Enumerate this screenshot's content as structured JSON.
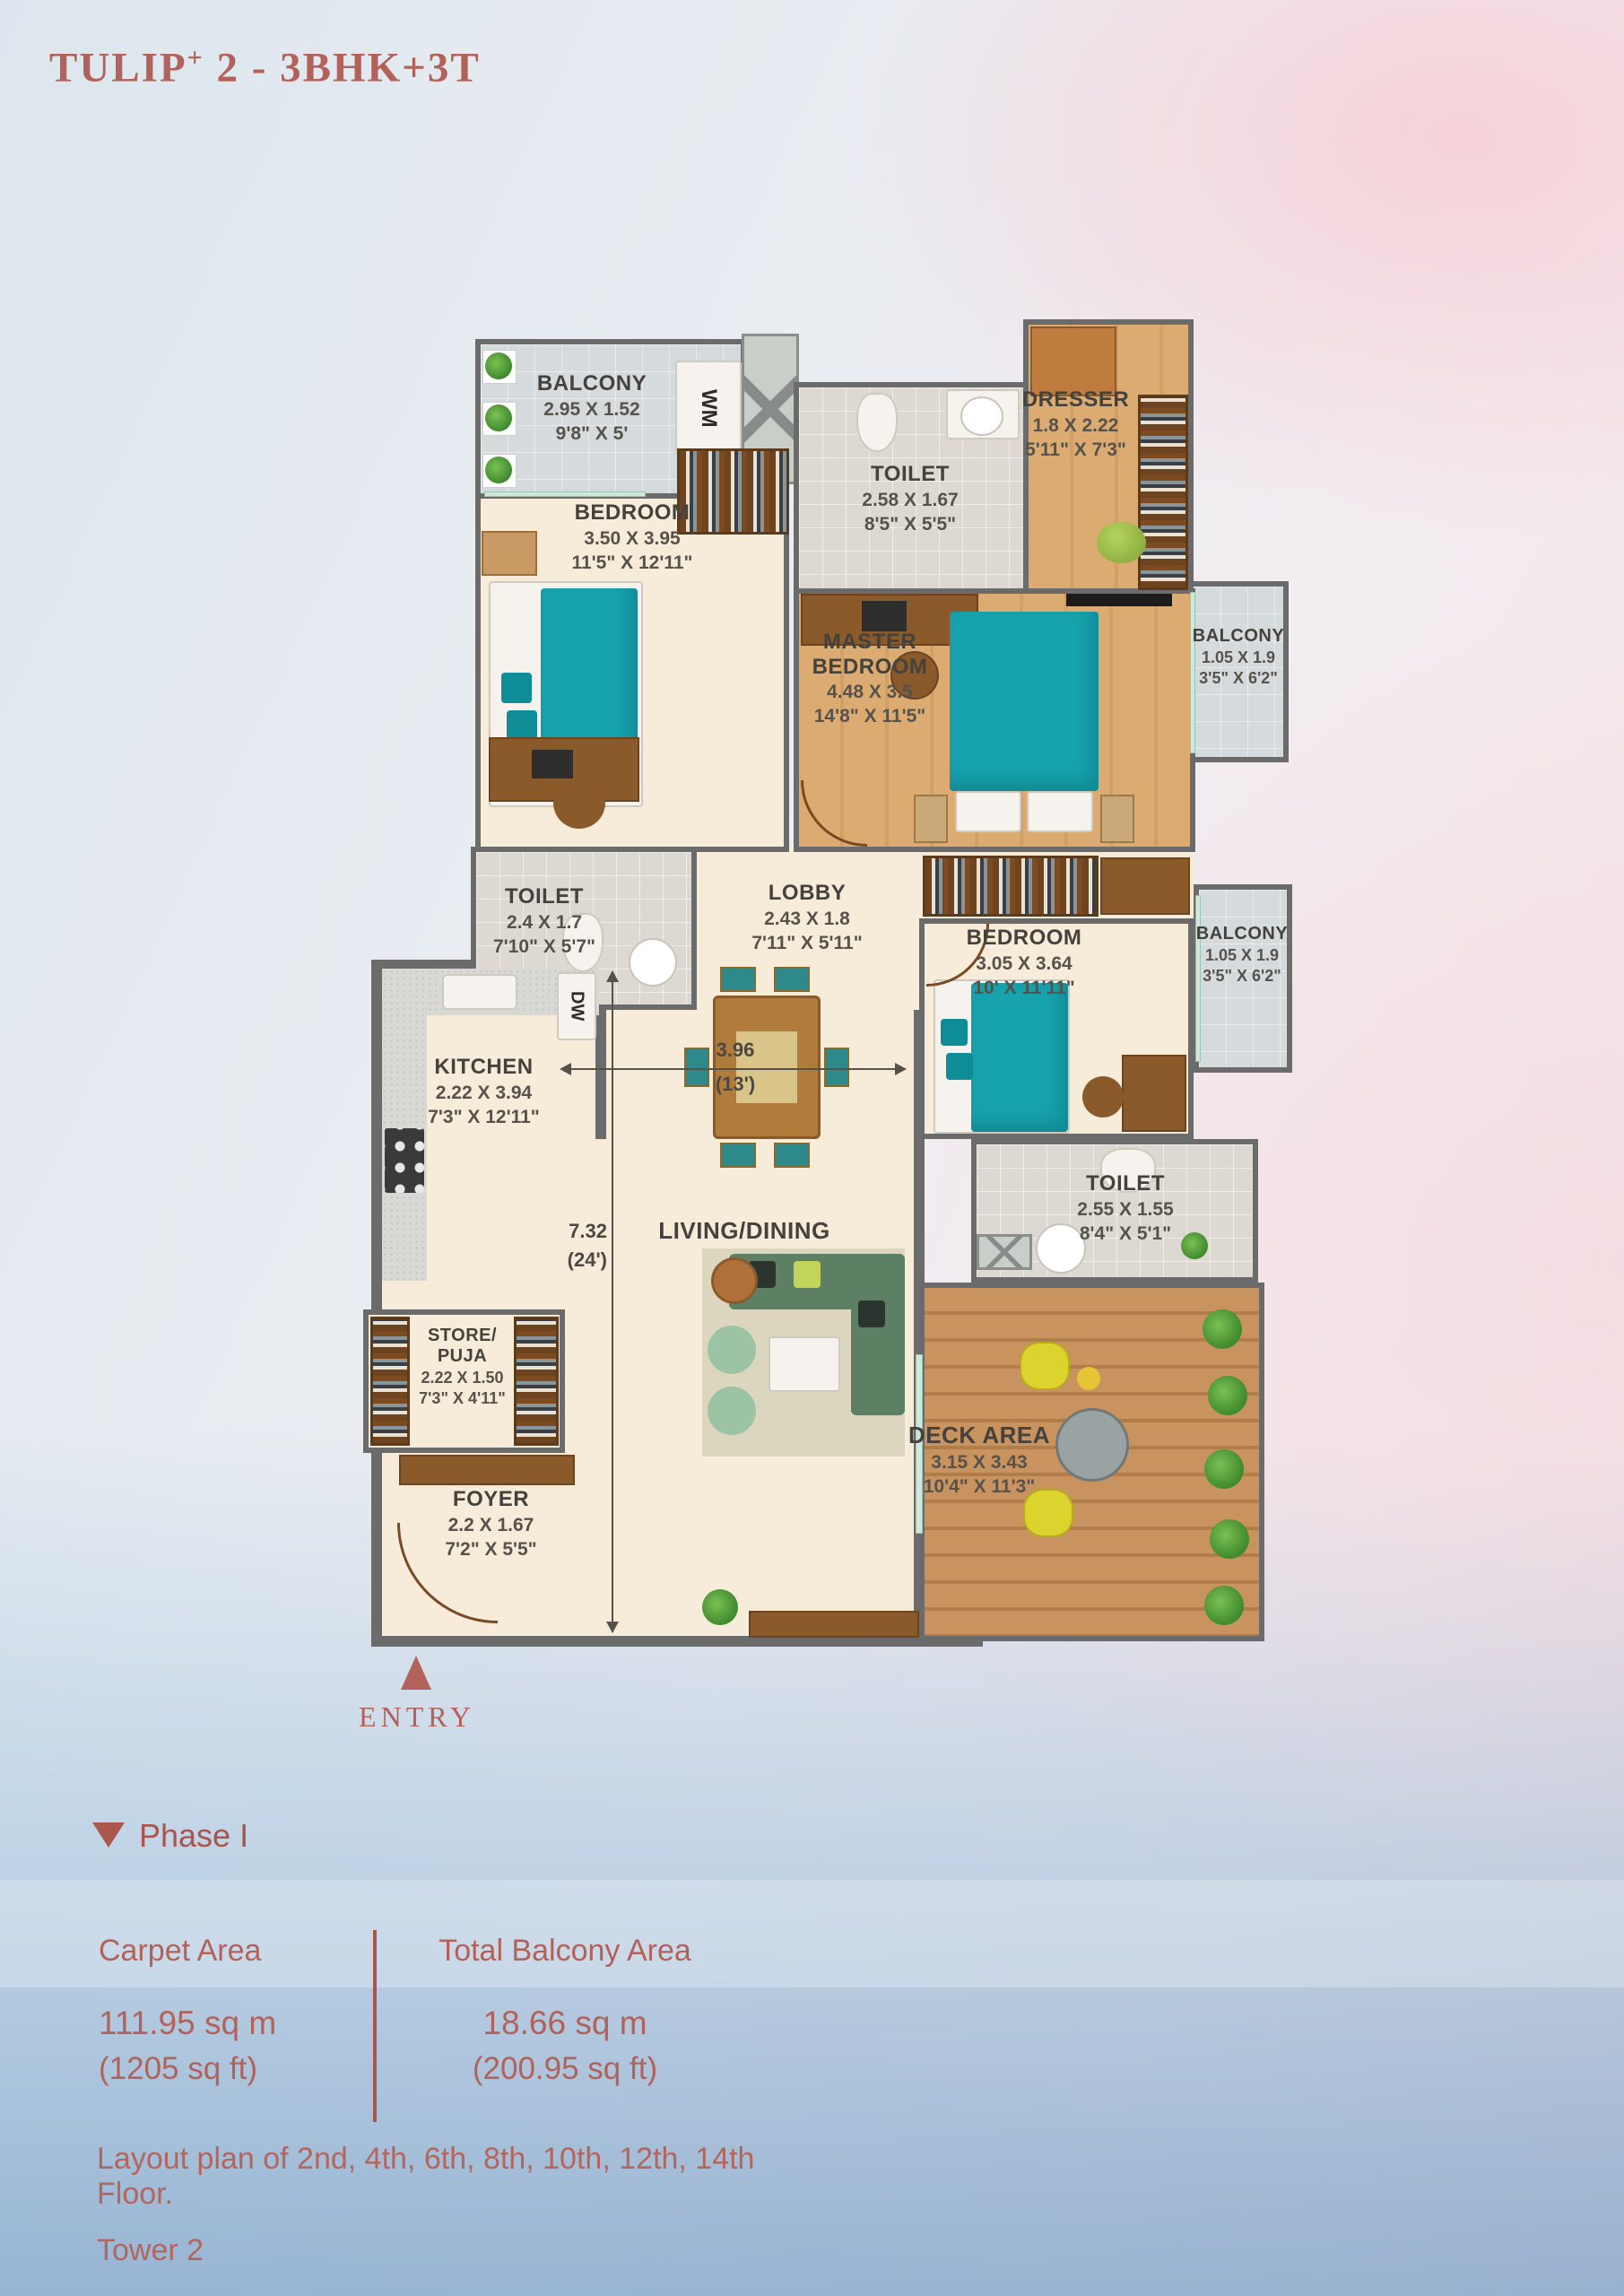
{
  "title": {
    "main": "TULIP",
    "sup": "+",
    "rest": " 2 - 3BHK+3T"
  },
  "plan": {
    "rooms": {
      "balcony_top": {
        "name": "BALCONY",
        "dim_m": "2.95 X 1.52",
        "dim_ft": "9'8\" X 5'"
      },
      "toilet_top": {
        "name": "TOILET",
        "dim_m": "2.58 X 1.67",
        "dim_ft": "8'5\" X 5'5\""
      },
      "dresser": {
        "name": "DRESSER",
        "dim_m": "1.8 X 2.22",
        "dim_ft": "5'11\" X 7'3\""
      },
      "bedroom1": {
        "name": "BEDROOM",
        "dim_m": "3.50 X 3.95",
        "dim_ft": "11'5\" X 12'11\""
      },
      "master": {
        "name1": "MASTER",
        "name2": "BEDROOM",
        "dim_m": "4.48 X 3.5",
        "dim_ft": "14'8\" X 11'5\""
      },
      "balcony_r1": {
        "name": "BALCONY",
        "dim_m": "1.05 X 1.9",
        "dim_ft": "3'5\" X 6'2\""
      },
      "toilet_mid": {
        "name": "TOILET",
        "dim_m": "2.4 X 1.7",
        "dim_ft": "7'10\" X 5'7\""
      },
      "lobby": {
        "name": "LOBBY",
        "dim_m": "2.43 X 1.8",
        "dim_ft": "7'11\" X 5'11\""
      },
      "bedroom2": {
        "name": "BEDROOM",
        "dim_m": "3.05 X 3.64",
        "dim_ft": "10' X 11'11\""
      },
      "balcony_r2": {
        "name": "BALCONY",
        "dim_m": "1.05 X 1.9",
        "dim_ft": "3'5\" X 6'2\""
      },
      "kitchen": {
        "name": "KITCHEN",
        "dim_m": "2.22 X 3.94",
        "dim_ft": "7'3\" X 12'11\""
      },
      "living": {
        "name": "LIVING/DINING"
      },
      "toilet_br": {
        "name": "TOILET",
        "dim_m": "2.55 X 1.55",
        "dim_ft": "8'4\" X 5'1\""
      },
      "store": {
        "name1": "STORE/",
        "name2": "PUJA",
        "dim_m": "2.22 X 1.50",
        "dim_ft": "7'3\" X 4'11\""
      },
      "foyer": {
        "name": "FOYER",
        "dim_m": "2.2 X 1.67",
        "dim_ft": "7'2\" X 5'5\""
      },
      "deck": {
        "name": "DECK AREA",
        "dim_m": "3.15 X 3.43",
        "dim_ft": "10'4\" X 11'3\""
      }
    },
    "appliances": {
      "wm": "WM",
      "dw": "DW"
    },
    "dimensions": {
      "width_m": "3.96",
      "width_ft": "(13')",
      "height_m": "7.32",
      "height_ft": "(24')"
    },
    "entry": "ENTRY"
  },
  "phase": {
    "label": "Phase I"
  },
  "areas": {
    "carpet": {
      "label": "Carpet Area",
      "value": "111.95 sq m",
      "alt": "(1205 sq ft)"
    },
    "balcony": {
      "label": "Total Balcony Area",
      "value": "18.66 sq m",
      "alt": "(200.95 sq ft)"
    }
  },
  "footer": {
    "line1": "Layout plan of 2nd, 4th, 6th, 8th, 10th, 12th, 14th Floor.",
    "line2": "Tower 2"
  },
  "colors": {
    "accent": "#b2625a",
    "wall": "#6b6b6b",
    "teal": "#17a3ad"
  }
}
